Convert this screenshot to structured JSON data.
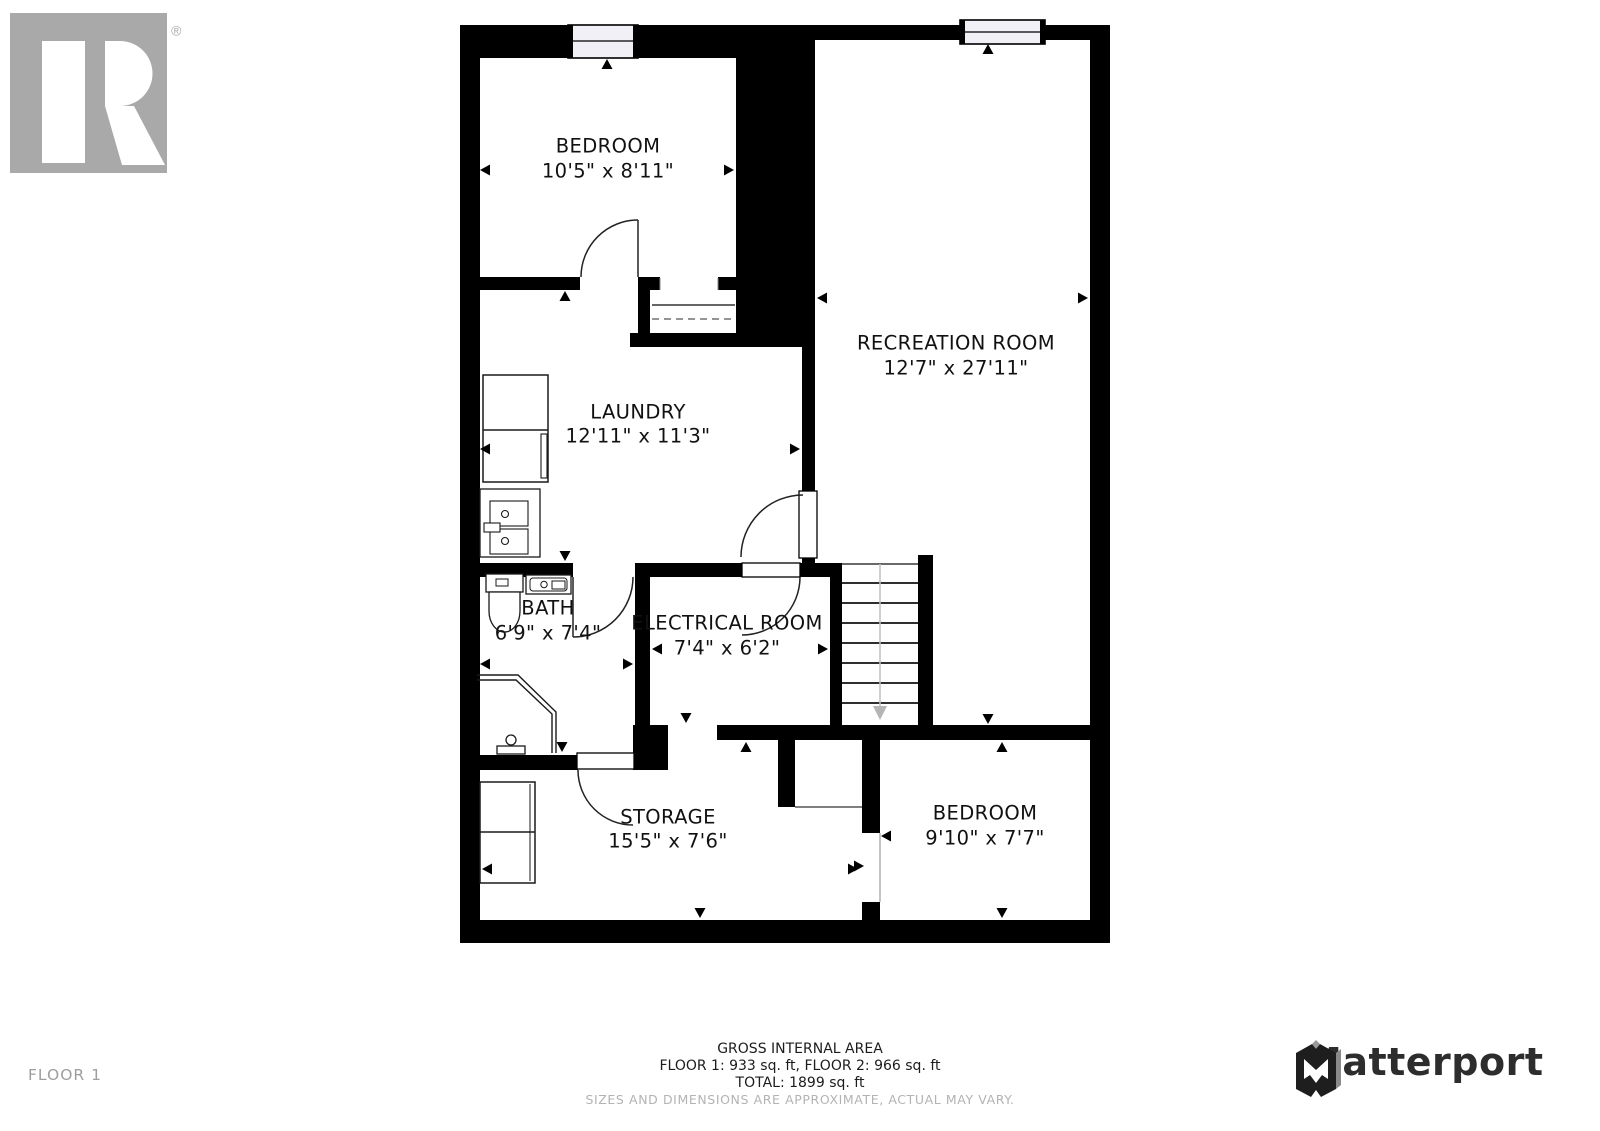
{
  "branding": {
    "realtor": {
      "label": "REALTOR",
      "registered_mark": "®"
    },
    "matterport": {
      "label": "Matterport"
    }
  },
  "floor": {
    "label": "FLOOR 1"
  },
  "rooms": [
    {
      "name": "BEDROOM",
      "dims": "10'5\" x 8'11\""
    },
    {
      "name": "RECREATION ROOM",
      "dims": "12'7\" x 27'11\""
    },
    {
      "name": "LAUNDRY",
      "dims": "12'11\" x 11'3\""
    },
    {
      "name": "BATH",
      "dims": "6'9\" x 7'4\""
    },
    {
      "name": "ELECTRICAL ROOM",
      "dims": "7'4\" x 6'2\""
    },
    {
      "name": "STORAGE",
      "dims": "15'5\" x 7'6\""
    },
    {
      "name": "BEDROOM",
      "dims": "9'10\" x 7'7\""
    }
  ],
  "footer": {
    "area_title": "GROSS INTERNAL AREA",
    "area_floors": "FLOOR 1: 933 sq. ft, FLOOR 2: 966 sq. ft",
    "area_total": "TOTAL: 1899 sq. ft",
    "disclaimer": "SIZES AND DIMENSIONS ARE APPROXIMATE, ACTUAL MAY VARY."
  },
  "colors": {
    "wall": "#000000",
    "floor": "#ffffff",
    "window_fill": "#f0f0f6",
    "muted_gray": "#a9a9a9",
    "stairs_arrow_gray": "#b5b5b5",
    "matterport_dark": "#2d2d2d"
  }
}
